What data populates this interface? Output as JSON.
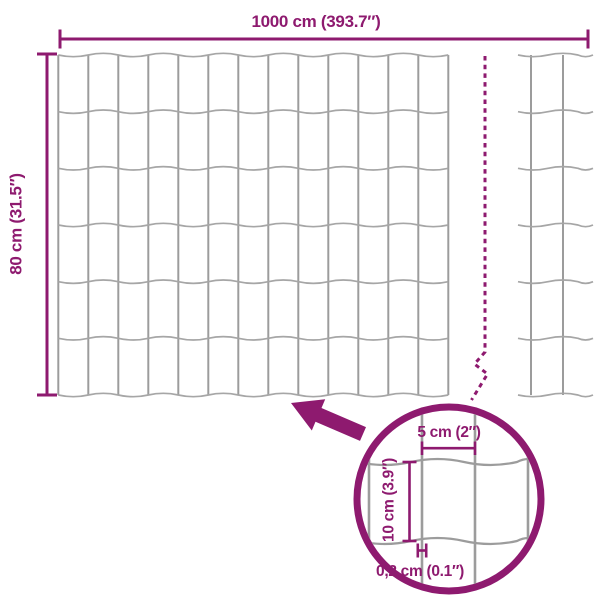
{
  "colors": {
    "accent": "#8E1A6F",
    "wire": "#9C9C9C",
    "wire_light": "#A6A6A6",
    "background": "#FFFFFF"
  },
  "dimensions": {
    "width_label": "1000 cm (393.7″)",
    "height_label": "80 cm (31.5″)"
  },
  "detail_callout": {
    "mesh_width_label": "5 cm (2″)",
    "mesh_height_label": "10 cm (3.9″)",
    "wire_thickness_label": "0,2 cm (0.1″)"
  }
}
